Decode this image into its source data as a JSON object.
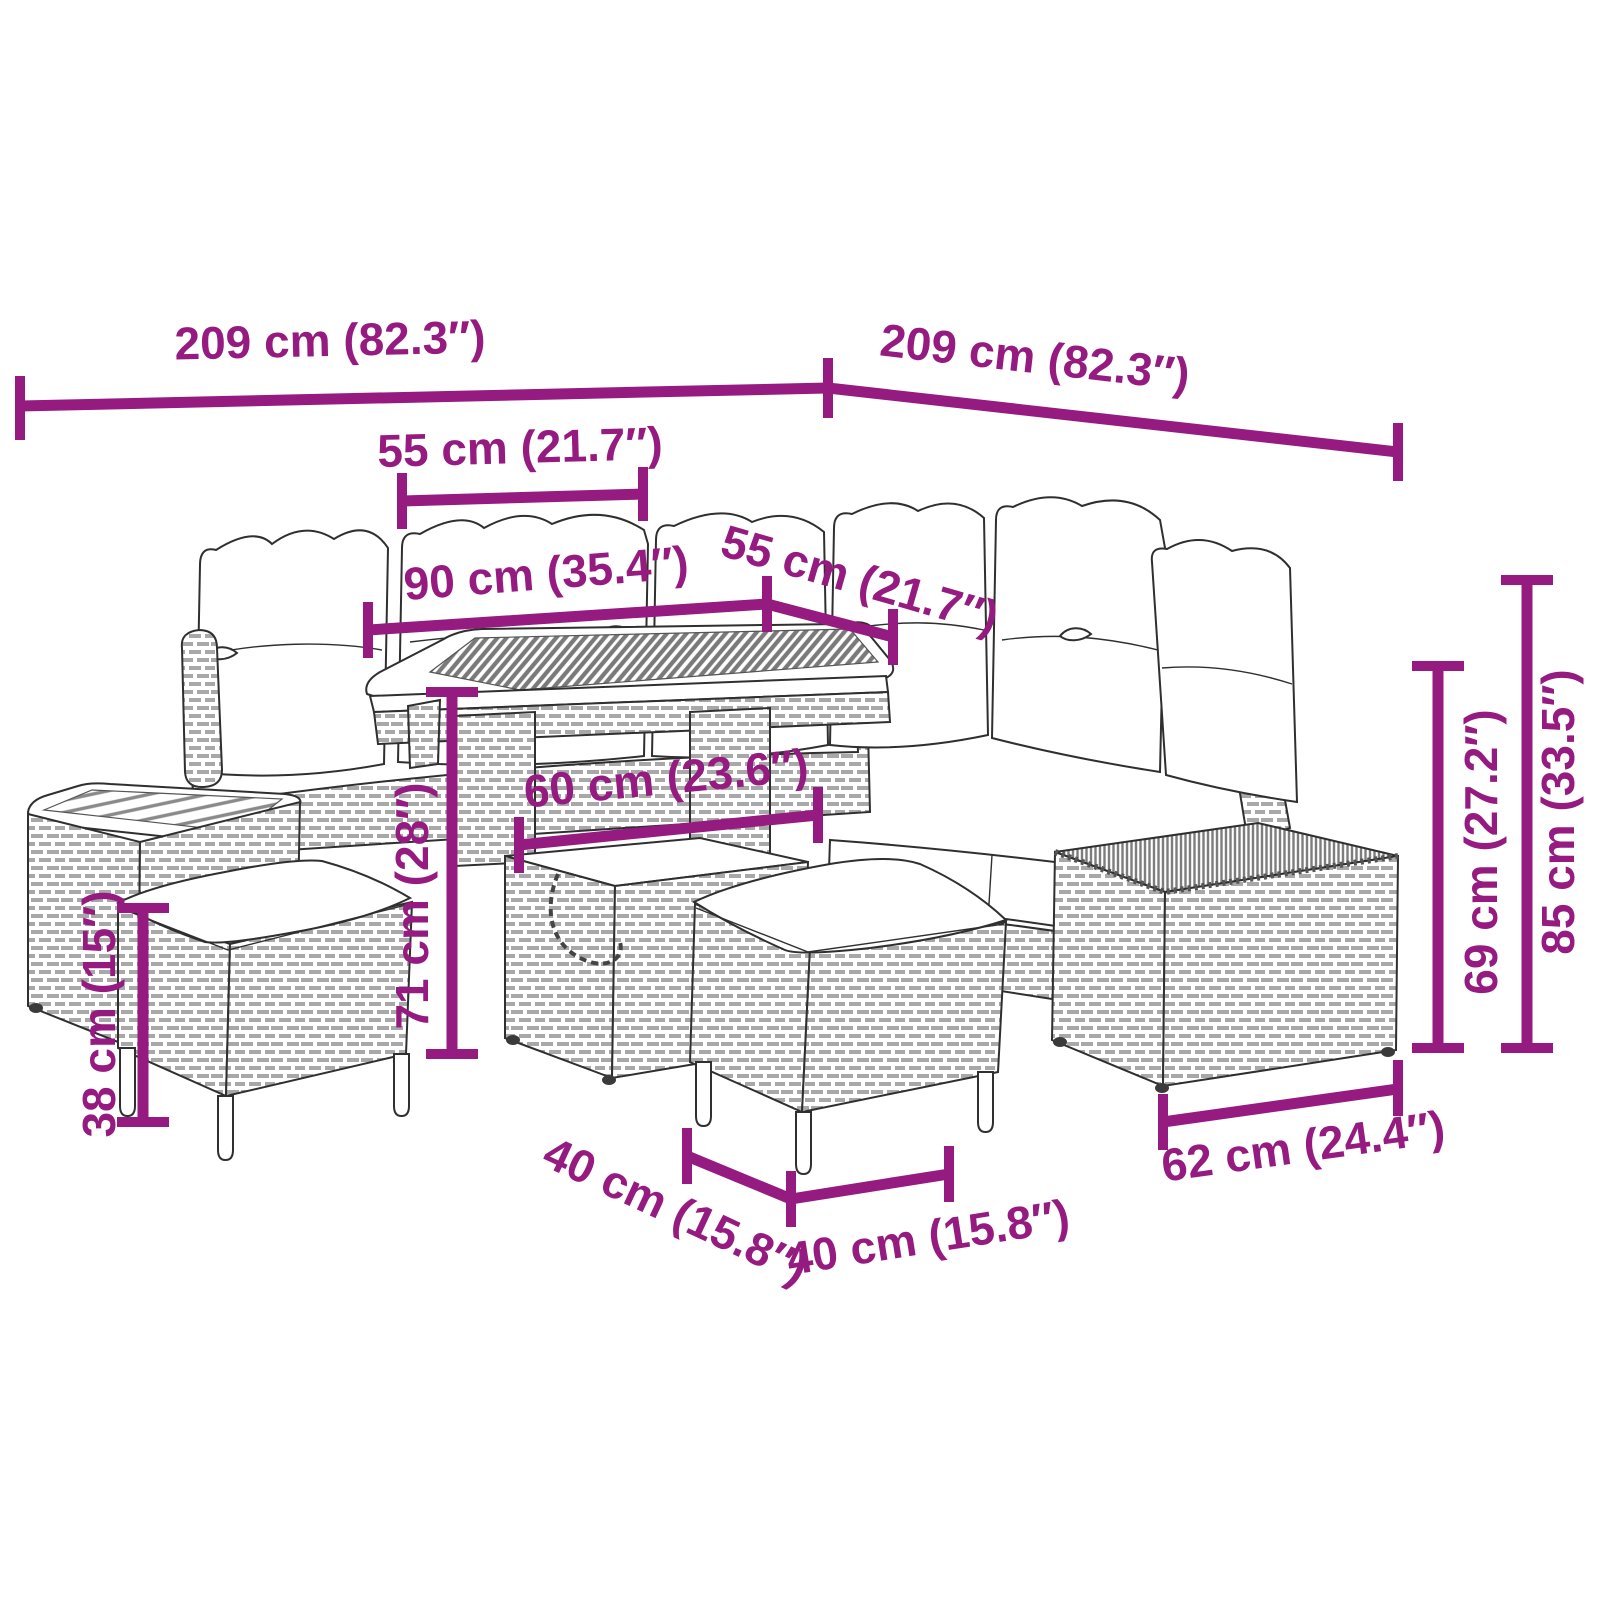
{
  "diagram": {
    "kind": "product-dimension-diagram",
    "subject": "rattan garden corner sofa set with table, stools and ottoman",
    "accent_color": "#951b81",
    "ink_color": "#2f2f2f",
    "background_color": "#ffffff"
  },
  "dimensions": {
    "overall_width_left": "209 cm (82.3″)",
    "overall_width_right": "209 cm (82.3″)",
    "seat_section_top": "55 cm (21.7″)",
    "table_length": "90 cm (35.4″)",
    "seat_section_right": "55 cm (21.7″)",
    "table_depth": "60 cm (23.6″)",
    "table_height": "71 cm (28″)",
    "stool_height": "38 cm (15″)",
    "seat_back_height": "69 cm (27.2″)",
    "overall_height": "85 cm (33.5″)",
    "stool_depth": "40 cm (15.8″)",
    "stool_width": "40 cm (15.8″)",
    "ottoman_width": "62 cm (24.4″)"
  },
  "furniture": {
    "pieces": [
      "corner sofa with back cushions",
      "height-adjustable dining table with slatted top",
      "side table with slatted top",
      "stool with cushion (left)",
      "stool with cushion (center)",
      "ottoman box"
    ]
  }
}
